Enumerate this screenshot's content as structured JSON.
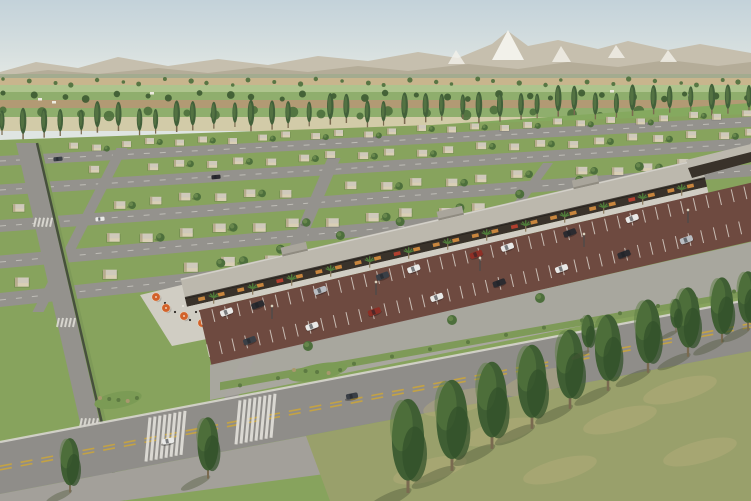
{
  "meta": {
    "title": "Aerial architectural rendering — master-planned residential community with retail strip",
    "description": "3D visualization: rows of single-storey beige flat-roof houses on lawns, diagonal neighborhood streets, a long retail colonnade with palm trees and cafe umbrellas, maroon parking lot with cars, a wide arterial road with double yellow lines, farmland bands, poplar tree rows and a mountain backdrop with a snow-capped peak"
  },
  "palette": {
    "sky_top": "#c3d2da",
    "sky_mid": "#d6dfdf",
    "sky_horizon": "#e9ece7",
    "mountain_back": "#c6bfae",
    "mountain_front": "#b2aa96",
    "snow": "#f2f1ea",
    "foothill": "#9dab8c",
    "field_tan": "#c8b58d",
    "field_tan_dark": "#b29a74",
    "field_green": "#8fae6d",
    "field_green_light": "#aec48d",
    "field_pale": "#d2cba8",
    "back_field_green": "#85a95f",
    "lawn": "#87a35d",
    "lawn_dark": "#6f904c",
    "tree_dark": "#3c5a31",
    "tree_mid": "#4d6f3c",
    "tree_light": "#6d8c4f",
    "poplar": "#42603a",
    "poplar_light": "#5f7f48",
    "street": "#94928d",
    "street_light": "#aaa8a1",
    "sidewalk": "#cbc8c0",
    "curb": "#d8d6cf",
    "hedge": "#3d4438",
    "shoulder": "#a3a09a",
    "house_wall": "#d9cfb5",
    "house_roof": "#cfc9bb",
    "house_shade": "#b0a483",
    "strip_roof": "#bcb8ad",
    "strip_roof_light": "#cdcac0",
    "strip_dark": "#39322a",
    "strip_glow": "#d08b3f",
    "strip_glow_red": "#b8402f",
    "walkway": "#d0cdc3",
    "palm_green": "#4f7c3a",
    "palm_trunk": "#8a7a5c",
    "parking": "#6e4a40",
    "parking_line": "#e6e2da",
    "road": "#8f8d89",
    "road_yellow": "#c9a53e",
    "road_white": "#e8e6df",
    "verge_grass": "#7e9a58",
    "island_green": "#7b9b55",
    "shrub": "#5d7a42",
    "shrub_dry": "#a8986d",
    "fg_field": "#99a06b",
    "fg_field_light": "#b6ac7d",
    "fg_shadow": "#4a5438",
    "fg_tree": "#3f5e33",
    "fg_tree_light": "#5c7d41",
    "trunk": "#7a6a50",
    "umbrella": "#d2622a",
    "sign_red": "#b03a2a",
    "sculpture_red": "#a84326",
    "pole": "#4a4a4a",
    "person": "#2e2a26",
    "car_white": "#e9e9e7",
    "car_black": "#2b2b30",
    "car_silver": "#b9bdc2",
    "car_dark": "#3a3f46",
    "car_red": "#8e2f26"
  },
  "scene": {
    "farmland_strips": [
      {
        "y": 78,
        "h": 7,
        "c": "field_tan"
      },
      {
        "y": 85,
        "h": 7,
        "c": "field_green_light"
      },
      {
        "y": 92,
        "h": 8,
        "c": "field_green"
      },
      {
        "y": 100,
        "h": 8,
        "c": "field_tan_dark"
      },
      {
        "y": 108,
        "h": 9,
        "c": "field_green"
      },
      {
        "y": 117,
        "h": 14,
        "c": "field_pale"
      }
    ],
    "farm_tree_bands": [
      {
        "y": 82,
        "count": 34,
        "r": 2.2,
        "c": "tree_mid"
      },
      {
        "y": 96,
        "count": 28,
        "r": 3.2,
        "c": "tree_dark"
      },
      {
        "y": 113,
        "count": 22,
        "r": 4.4,
        "c": "tree_mid"
      }
    ],
    "farm_buildings": [
      [
        38,
        98
      ],
      [
        52,
        101
      ],
      [
        150,
        92
      ],
      [
        610,
        90
      ],
      [
        688,
        94
      ]
    ],
    "poplar_row": {
      "count": 40,
      "x0": 4,
      "x1": 748,
      "y0": 138,
      "y1": 112
    },
    "house_rows": [
      {
        "y0": 147,
        "slope": -0.048,
        "x0": 12,
        "dx": 27,
        "count": 28,
        "s": 0.6
      },
      {
        "y0": 172,
        "slope": -0.058,
        "x0": 26,
        "dx": 30,
        "count": 25,
        "s": 0.68
      },
      {
        "y0": 207,
        "slope": -0.068,
        "x0": 16,
        "dx": 33,
        "count": 22,
        "s": 0.76
      },
      {
        "y0": 243,
        "slope": -0.082,
        "x0": 30,
        "dx": 37,
        "count": 18,
        "s": 0.85
      },
      {
        "y0": 281,
        "slope": -0.1,
        "x0": 18,
        "dx": 41,
        "count": 12,
        "s": 0.92
      }
    ],
    "row_streets": [
      {
        "y0": 161,
        "slope": -0.052,
        "w": 10
      },
      {
        "y0": 190,
        "slope": -0.062,
        "w": 11
      },
      {
        "y0": 226,
        "slope": -0.074,
        "w": 12
      },
      {
        "y0": 262,
        "slope": -0.088,
        "w": 13
      },
      {
        "y0": 300,
        "slope": -0.105,
        "w": 14
      }
    ],
    "cross_streets": [
      {
        "xt": 122,
        "yt": 148,
        "xb": 38,
        "yb": 312,
        "w": 11
      },
      {
        "xt": 334,
        "yt": 158,
        "xb": 218,
        "yb": 428,
        "w": 13
      },
      {
        "xt": 548,
        "yt": 163,
        "xb": 476,
        "yb": 262,
        "w": 10
      }
    ],
    "left_boulevard": {
      "xt": 26,
      "yt": 143,
      "xb": 108,
      "yb": 501,
      "w": 20
    },
    "strip": {
      "x0": 185,
      "y0": 298,
      "x1": 705,
      "y1": 178,
      "roof_w": 20,
      "colonnade_w": 9,
      "storefronts": 26,
      "palms": 13,
      "towers": [
        0.22,
        0.52,
        0.78
      ],
      "rear_trees": 8
    },
    "parking": {
      "off0": 15,
      "off1": 72,
      "t0": 0.02,
      "t1": 1.1,
      "stall_spacing": 13,
      "cars_row1": [
        0.07,
        0.13,
        0.25,
        0.37,
        0.43,
        0.55,
        0.61,
        0.73,
        0.85
      ],
      "cars_row2": [
        0.1,
        0.22,
        0.34,
        0.46,
        0.58,
        0.7,
        0.82,
        0.94
      ],
      "car_colors": [
        "car_white",
        "car_black",
        "car_silver",
        "car_dark",
        "car_white",
        "car_red",
        "car_white",
        "car_black"
      ],
      "pole_ts": [
        0.15,
        0.35,
        0.55,
        0.75,
        0.95
      ]
    },
    "cafe": {
      "plaza": [
        [
          140,
          295
        ],
        [
          202,
          280
        ],
        [
          252,
          330
        ],
        [
          172,
          346
        ]
      ],
      "gable": [
        [
          188,
          290
        ],
        [
          262,
          272
        ],
        [
          272,
          284
        ],
        [
          198,
          302
        ]
      ],
      "umbrellas": [
        [
          166,
          308
        ],
        [
          184,
          316
        ],
        [
          202,
          323
        ],
        [
          220,
          330
        ],
        [
          156,
          297
        ]
      ],
      "people": [
        [
          175,
          312
        ],
        [
          190,
          320
        ],
        [
          207,
          327
        ],
        [
          183,
          306
        ],
        [
          214,
          320
        ],
        [
          165,
          303
        ],
        [
          196,
          312
        ]
      ]
    },
    "main_road": {
      "y_left": 468,
      "slope": -0.19,
      "w": 52,
      "crosswalk_x": [
        150,
        240
      ]
    },
    "islands": [
      {
        "x": 318,
        "y": 372,
        "rx": 30,
        "ry": 8
      },
      {
        "x": 118,
        "y": 400,
        "rx": 24,
        "ry": 8
      },
      {
        "x": 648,
        "y": 238,
        "rx": 30,
        "ry": 11
      }
    ],
    "road_cars": [
      {
        "x": 168,
        "y": 441,
        "c": "car_white"
      },
      {
        "x": 352,
        "y": 396,
        "c": "car_dark"
      },
      {
        "x": 648,
        "y": 339,
        "c": "car_black"
      }
    ],
    "resident_cars": [
      {
        "x": 100,
        "y": 219,
        "c": "car_white"
      },
      {
        "x": 58,
        "y": 159,
        "c": "car_dark"
      },
      {
        "x": 216,
        "y": 177,
        "c": "car_black"
      }
    ],
    "verge_trees": [
      [
        308,
        346
      ],
      [
        452,
        320
      ],
      [
        540,
        298
      ]
    ],
    "verge_shrub_step": 38,
    "fg_trees": [
      [
        408,
        492,
        95
      ],
      [
        452,
        470,
        92
      ],
      [
        492,
        448,
        88
      ],
      [
        532,
        428,
        85
      ],
      [
        570,
        408,
        80
      ],
      [
        608,
        390,
        77
      ],
      [
        648,
        372,
        74
      ],
      [
        688,
        356,
        70
      ],
      [
        722,
        342,
        66
      ],
      [
        748,
        330,
        60
      ],
      [
        588,
        352,
        38
      ],
      [
        676,
        332,
        34
      ],
      [
        208,
        478,
        62
      ],
      [
        70,
        492,
        55
      ]
    ],
    "fg_mottles": [
      [
        430,
        470
      ],
      [
        500,
        432
      ],
      [
        560,
        470
      ],
      [
        620,
        420
      ],
      [
        680,
        390
      ],
      [
        700,
        452
      ],
      [
        540,
        382
      ],
      [
        460,
        402
      ]
    ],
    "secondary_strip": {
      "dark": [
        [
          688,
          168
        ],
        [
          751,
          152
        ],
        [
          751,
          162
        ],
        [
          692,
          178
        ]
      ],
      "roof": [
        [
          686,
          160
        ],
        [
          751,
          144
        ],
        [
          751,
          154
        ],
        [
          690,
          170
        ]
      ]
    },
    "sign": {
      "x": 732,
      "y": 192,
      "w": 16,
      "h": 11
    }
  }
}
